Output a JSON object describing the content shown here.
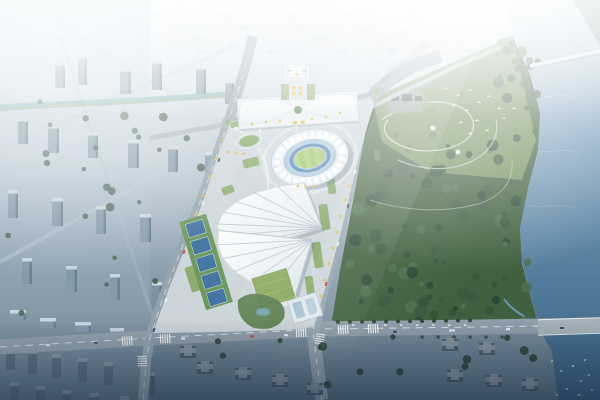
{
  "scene": {
    "type": "aerial-architectural-rendering",
    "setting": "bird's-eye render of a riverside sports-center masterplan in hazy morning light",
    "landmarks": [
      "convention-center",
      "grand-theater-tower",
      "main-stadium",
      "practice-track",
      "fan-roof-hall-north",
      "fan-roof-hall-south",
      "tennis-courts",
      "green-roof-building",
      "office-building",
      "central-plaza",
      "forest-park",
      "meadow-garden",
      "temple-pavilion",
      "river",
      "cross-river-bridge",
      "riverside-bridge-road",
      "city-district",
      "residential-towers",
      "marina-boats",
      "egret-flock"
    ],
    "counts": {
      "fan_roof_halls": 2,
      "tennis_courts": 5,
      "roundabouts": 2,
      "bridges": 2,
      "birds": 14
    }
  },
  "colors": {
    "base_top": "#e6eef3",
    "base_upper": "#bccbd5",
    "base_lower": "#8a9dac",
    "base_bottom": "#5e7484",
    "haze": "#ffffff",
    "water_top": "#cfe1ea",
    "water_mid": "#7da0bb",
    "water_deep": "#527c9c",
    "water_bottom": "#3a6080",
    "far_bank": "#7a8f8e",
    "bridge_deck": "#e2e9ec",
    "forest_dark": "#2c4834",
    "forest_mid": "#3a5a40",
    "forest_light": "#4c7050",
    "meadow": "#74935e",
    "park_path": "#cdd8d2",
    "road": "#8f9ea8",
    "road_light": "#a6b2b9",
    "road_edge": "#76868f",
    "lane_mark": "#f5f8f9",
    "plaza": "#cdd6da",
    "plaza_path": "#eef2f4",
    "stadium_ring": "#f4f8fa",
    "stadium_ring_shade": "#a9bfcd",
    "stadium_bowl": "#a4c2d8",
    "track_blue": "#4e86b6",
    "pitch_green": "#9cc364",
    "pitch_stripe": "#a8cf72",
    "fan_white": "#f7fafc",
    "fan_shade": "#dde6ec",
    "fan_rib": "#b6c2cb",
    "court_blue": "#3c6f9e",
    "court_green": "#679456",
    "lawn": "#7fa45c",
    "gold_tree": "#e3b440",
    "gold_accent": "#e8bc3f",
    "roof_green": "#8aa85e",
    "office_white": "#dfe8ed",
    "conv_roof": "#fbfdfe",
    "conv_shade": "#e3ebf0",
    "conv_center_green": "#5d8a50",
    "tower_white": "#eef3f6",
    "city_face": "#7c92a3",
    "city_top": "#c8d6de",
    "city_side": "#5d7284",
    "city_tree": "#3a5a46",
    "canal": "#7fb3b8",
    "temple_roof": "#3f4b52",
    "temple_base": "#8d9a98",
    "pond": "#6fa3ad",
    "shadow_bldg": "#4e5e6c",
    "shadow_roof": "#8b98a2",
    "bird": "#ffffff",
    "boat": "#e8eef0",
    "car_white": "#eef2f4",
    "car_dark": "#3f4e59",
    "car_red": "#c74a3c",
    "bus_white": "#e6e9ea",
    "vignette": "#14283c"
  }
}
